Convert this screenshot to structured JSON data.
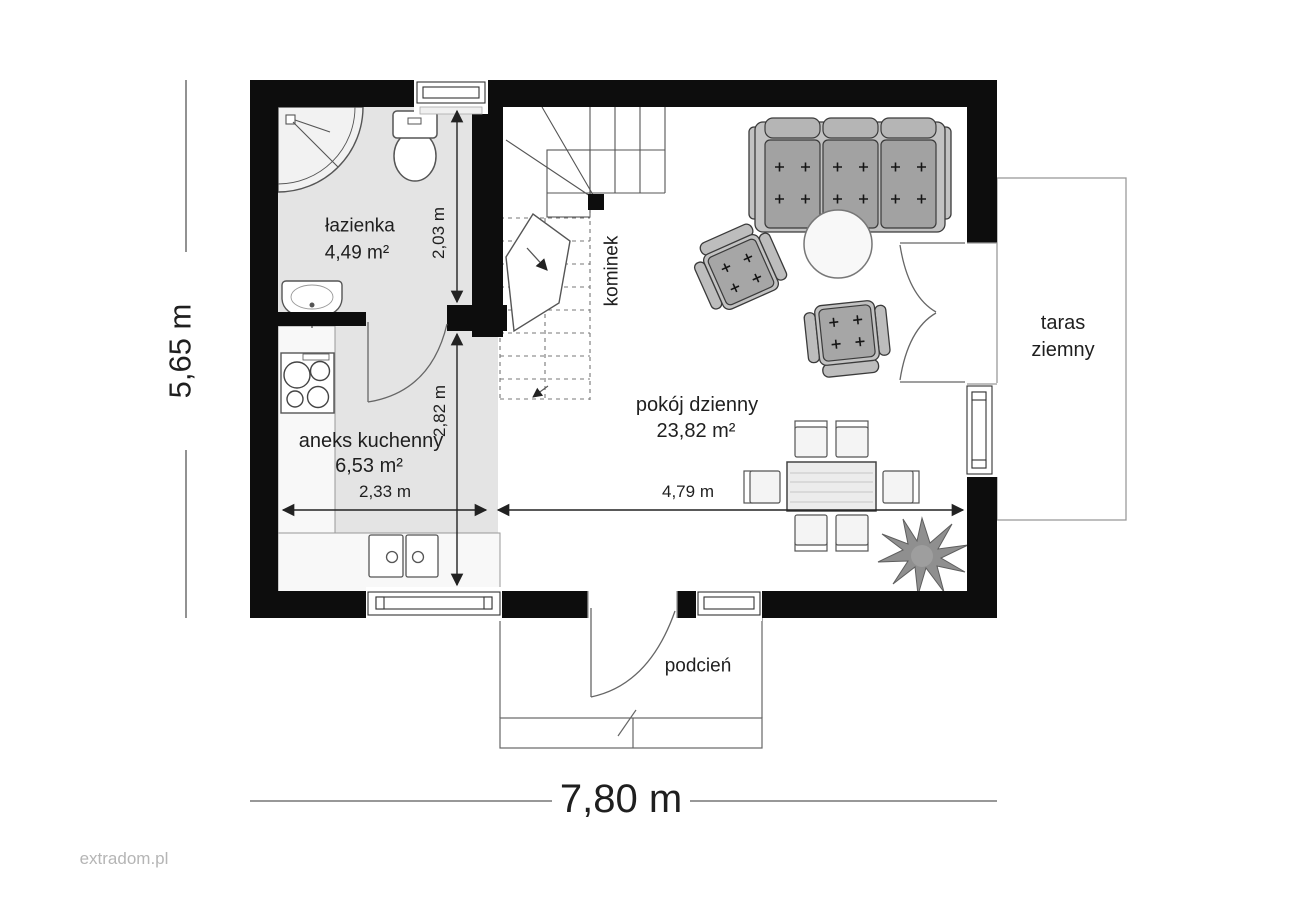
{
  "watermark": "extradom.pl",
  "rooms": {
    "bathroom": {
      "name": "łazienka",
      "area": "4,49 m²"
    },
    "kitchen": {
      "name": "aneks kuchenny",
      "area": "6,53 m²"
    },
    "living_room": {
      "name": "pokój dzienny",
      "area": "23,82 m²"
    },
    "terrace": {
      "name": "taras ziemny"
    },
    "porch": {
      "name": "podcień"
    },
    "fireplace": {
      "name": "kominek"
    }
  },
  "dimensions": {
    "overall_width": "7,80 m",
    "overall_depth": "5,65 m",
    "bathroom_depth": "2,03 m",
    "hall_depth": "2,82 m",
    "kitchen_width": "2,33 m",
    "living_width": "4,79 m"
  },
  "colors": {
    "wall": "#0d0d0d",
    "shaded_floor": "#e4e4e4",
    "furniture_fill": "#a2a2a2",
    "outline": "#555555"
  },
  "fixtures": [
    "shower-icon",
    "toilet-icon",
    "washbasin-icon",
    "cooktop-icon",
    "kitchen-sink-icon",
    "sofa-icon",
    "armchair-icon",
    "coffee-table-icon",
    "dining-table-icon",
    "chair-icon",
    "plant-icon",
    "stairs-icon",
    "fireplace-icon",
    "door-swing-icon",
    "window-icon"
  ]
}
